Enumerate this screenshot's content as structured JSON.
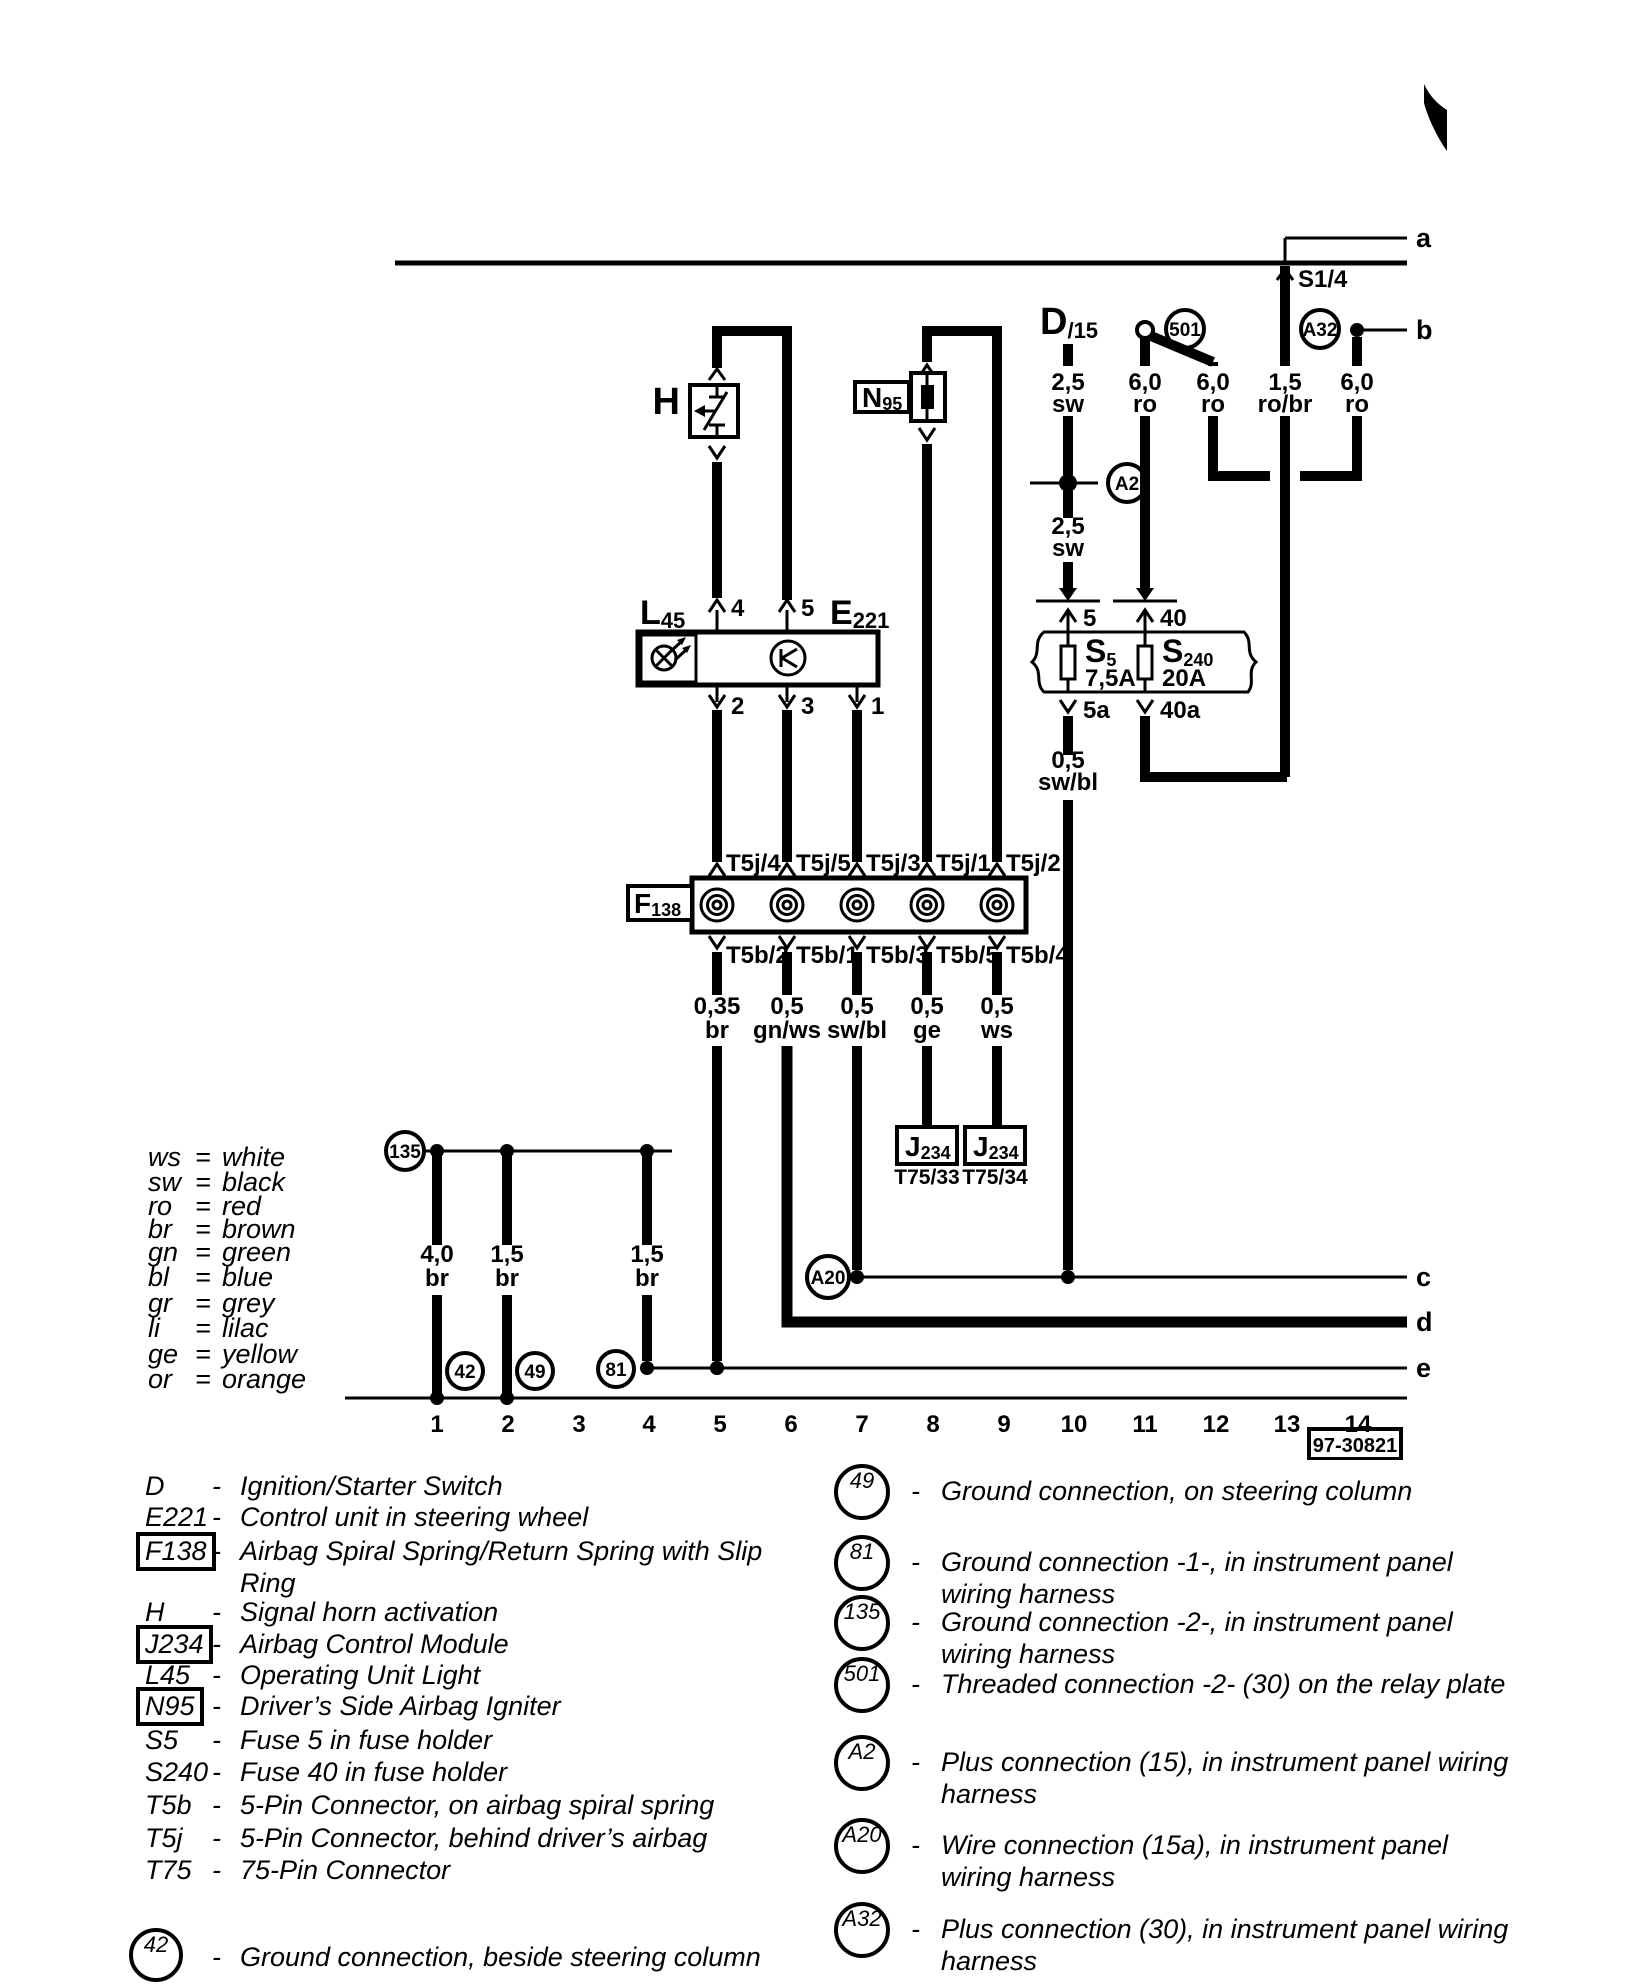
{
  "ui": {
    "dash": "-"
  },
  "diagram": {
    "page_links": {
      "a": "a",
      "b": "b",
      "c": "c",
      "d": "d",
      "e": "e"
    },
    "s14": "S1/4",
    "d15": {
      "l": "D",
      "s": "/15"
    },
    "top_gauges": [
      {
        "size": "2,5",
        "color": "sw"
      },
      {
        "size": "6,0",
        "color": "ro"
      },
      {
        "size": "6,0",
        "color": "ro"
      },
      {
        "size": "1,5",
        "color": "ro/br"
      },
      {
        "size": "6,0",
        "color": "ro"
      }
    ],
    "mid_gauge": {
      "size": "2,5",
      "color": "sw"
    },
    "fuse_out_gauge": {
      "size": "0,5",
      "color": "sw/bl"
    },
    "fuse5": {
      "l": "S",
      "s": "5",
      "amp": "7,5A",
      "pin_in": "5",
      "pin_out": "5a"
    },
    "fuse40": {
      "l": "S",
      "s": "240",
      "amp": "20A",
      "pin_in": "40",
      "pin_out": "40a"
    },
    "circles": {
      "c501": "501",
      "a2": "A2",
      "a20": "A20",
      "a32": "A32",
      "g135": "135",
      "g42": "42",
      "g49": "49",
      "g81": "81"
    },
    "h": "H",
    "n95": {
      "l": "N",
      "s": "95"
    },
    "l45": {
      "l": "L",
      "s": "45"
    },
    "e221": {
      "l": "E",
      "s": "221"
    },
    "f138": {
      "l": "F",
      "s": "138"
    },
    "j234": {
      "l": "J",
      "s": "234"
    },
    "t75_pins": [
      "T75/33",
      "T75/34"
    ],
    "pins": {
      "p4": "4",
      "p5": "5",
      "p2": "2",
      "p3": "3",
      "p1": "1"
    },
    "t5j": [
      "T5j/4",
      "T5j/5",
      "T5j/3",
      "T5j/1",
      "T5j/2"
    ],
    "t5b": [
      "T5b/2",
      "T5b/1",
      "T5b/3",
      "T5b/5",
      "T5b/4"
    ],
    "branch_gauges": [
      {
        "size": "0,35",
        "color": "br"
      },
      {
        "size": "0,5",
        "color": "gn/ws"
      },
      {
        "size": "0,5",
        "color": "sw/bl"
      },
      {
        "size": "0,5",
        "color": "ge"
      },
      {
        "size": "0,5",
        "color": "ws"
      }
    ],
    "ground_gauges": [
      {
        "size": "4,0",
        "color": "br"
      },
      {
        "size": "1,5",
        "color": "br"
      },
      {
        "size": "1,5",
        "color": "br"
      }
    ],
    "tracks": [
      "1",
      "2",
      "3",
      "4",
      "5",
      "6",
      "7",
      "8",
      "9",
      "10",
      "11",
      "12",
      "13",
      "14"
    ],
    "number": "97-30821"
  },
  "legend": {
    "eq": "=",
    "items": [
      {
        "abbr": "ws",
        "name": "white"
      },
      {
        "abbr": "sw",
        "name": "black"
      },
      {
        "abbr": "ro",
        "name": "red"
      },
      {
        "abbr": "br",
        "name": "brown"
      },
      {
        "abbr": "gn",
        "name": "green"
      },
      {
        "abbr": "bl",
        "name": "blue"
      },
      {
        "abbr": "gr",
        "name": "grey"
      },
      {
        "abbr": "li",
        "name": "lilac"
      },
      {
        "abbr": "ge",
        "name": "yellow"
      },
      {
        "abbr": "or",
        "name": "orange"
      }
    ]
  },
  "components": [
    {
      "code": "D",
      "desc": "Ignition/Starter Switch"
    },
    {
      "code": "E221",
      "desc": "Control unit in steering wheel"
    },
    {
      "code": "F138",
      "desc": "Airbag Spiral Spring/Return Spring with Slip",
      "desc2": "Ring"
    },
    {
      "code": "H",
      "desc": "Signal horn activation"
    },
    {
      "code": "J234",
      "desc": "Airbag Control Module"
    },
    {
      "code": "L45",
      "desc": "Operating Unit Light"
    },
    {
      "code": "N95",
      "desc": "Driver’s Side Airbag Igniter"
    },
    {
      "code": "S5",
      "desc": "Fuse 5 in fuse holder"
    },
    {
      "code": "S240",
      "desc": "Fuse 40 in fuse holder"
    },
    {
      "code": "T5b",
      "desc": "5-Pin Connector, on airbag spiral spring"
    },
    {
      "code": "T5j",
      "desc": "5-Pin Connector, behind driver’s airbag"
    },
    {
      "code": "T75",
      "desc": "75-Pin Connector"
    },
    {
      "code": "42",
      "desc": "Ground connection, beside steering column"
    }
  ],
  "connections": [
    {
      "code": "49",
      "line1": "Ground connection, on steering column"
    },
    {
      "code": "81",
      "line1": "Ground connection -1-, in instrument panel",
      "line2": "wiring harness"
    },
    {
      "code": "135",
      "line1": "Ground connection -2-, in instrument panel",
      "line2": "wiring harness"
    },
    {
      "code": "501",
      "line1": "Threaded connection -2- (30) on the relay plate"
    },
    {
      "code": "A2",
      "line1": "Plus connection (15), in instrument panel wiring",
      "line2": "harness"
    },
    {
      "code": "A20",
      "line1": "Wire connection (15a), in instrument panel",
      "line2": "wiring harness"
    },
    {
      "code": "A32",
      "line1": "Plus connection (30), in instrument panel wiring",
      "line2": "harness"
    }
  ]
}
